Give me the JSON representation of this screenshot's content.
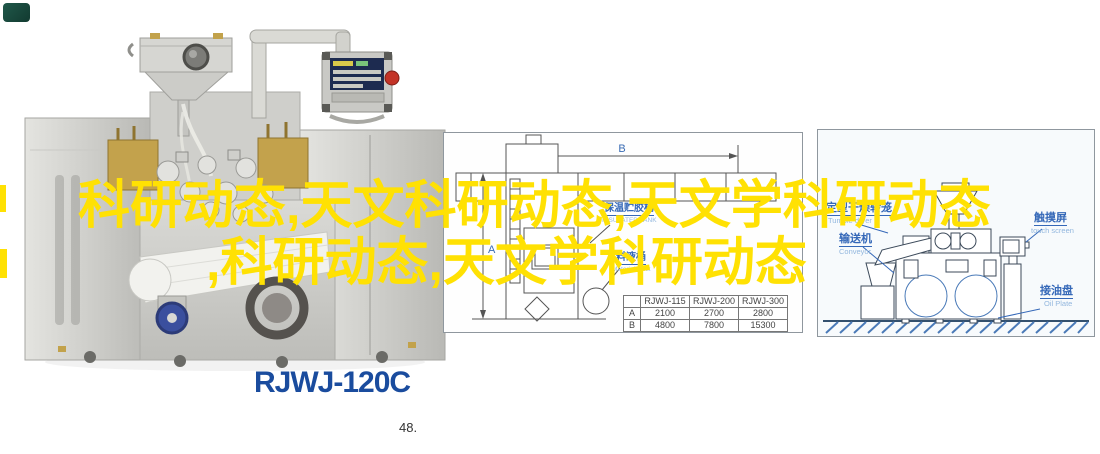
{
  "overlay": {
    "line1": "科研动态,天文科研动态,天文学科研动态",
    "line2": ",科研动态,天文学科研动态"
  },
  "photo": {
    "model_label": "RJWJ-120C"
  },
  "page_number": "48.",
  "colors": {
    "overlay_yellow": "#FFE103",
    "model_blue": "#1A4C9E",
    "label_blue": "#3568B8",
    "label_blue_light": "#93B7DE"
  },
  "middle_diagram": {
    "dim_a": "A",
    "dim_b": "B",
    "labels": {
      "insulated_tank_cn": "保温贮胶桶",
      "insulated_tank_en": "INSULATED TANK",
      "material_tank_cn": "料液桶",
      "material_tank_en": "Material Tank"
    },
    "table": {
      "headers": [
        "",
        "RJWJ-115",
        "RJWJ-200",
        "RJWJ-300"
      ],
      "rows": [
        {
          "label": "A",
          "values": [
            "2100",
            "2700",
            "2800"
          ]
        },
        {
          "label": "B",
          "values": [
            "4800",
            "7800",
            "15300"
          ]
        }
      ]
    }
  },
  "right_diagram": {
    "labels": {
      "tumble_dryer_cn": "定型干燥转笼",
      "tumble_dryer_en": "Tumble dryer",
      "conveyor_cn": "输送机",
      "conveyor_en": "Conveyor",
      "touch_screen_cn": "触摸屏",
      "touch_screen_en": "touch screen",
      "oil_plate_cn": "接油盘",
      "oil_plate_en": "Oil Plate"
    }
  }
}
